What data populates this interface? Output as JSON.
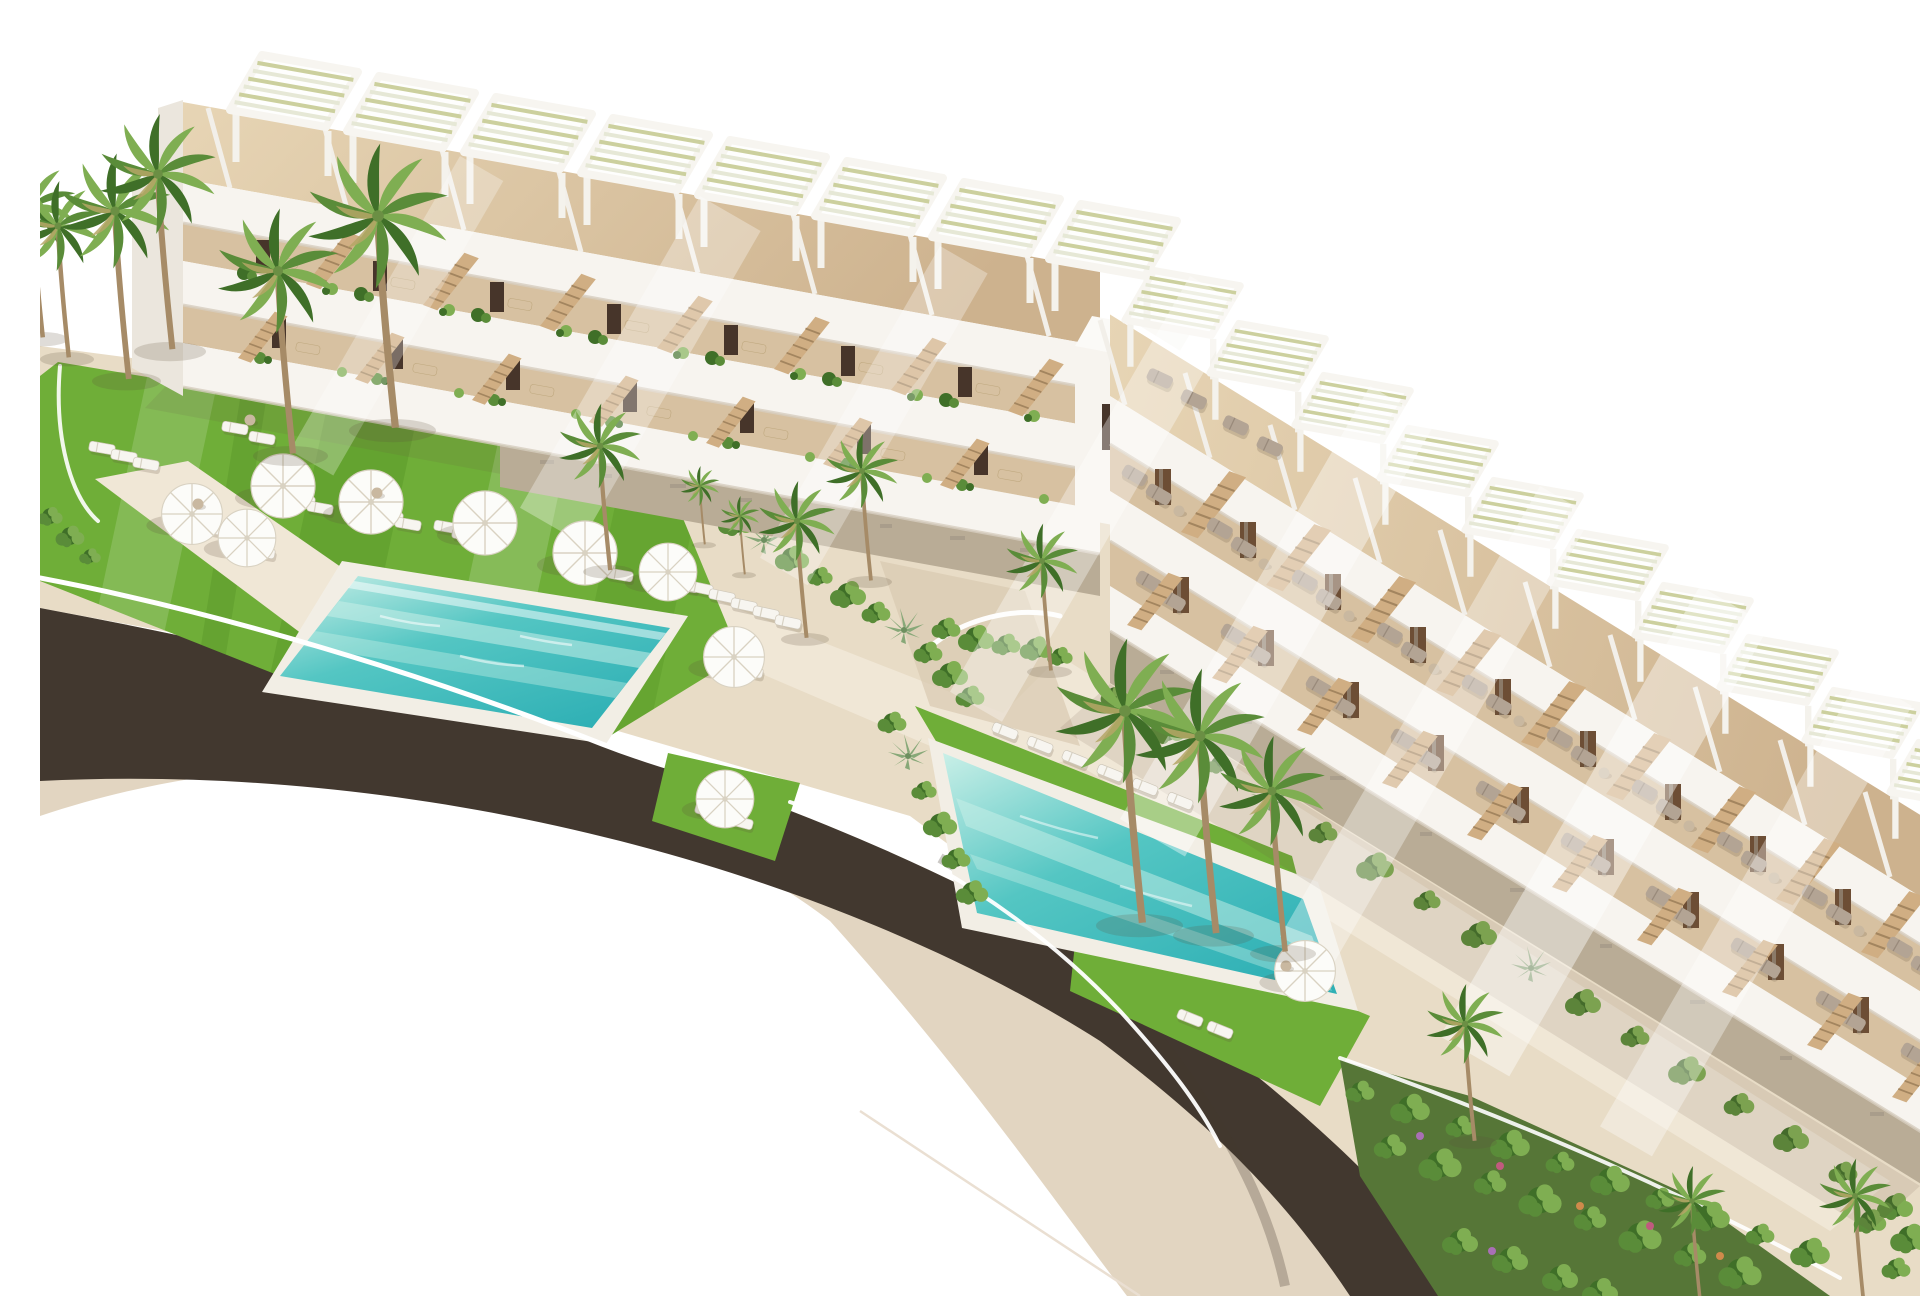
{
  "scene": {
    "title": "Aerial 3D architectural render of a white terraced seaside apartment complex",
    "setting_note": "Two long white terraced apartment blocks with rooftop pergolas and tan roof decks step diagonally across the frame. In front lie bright lawns with white parasols and sun loungers, two turquoise swimming pools with white decks, lush shrub and agave beds, tall fan palms, light stone promenades and a dark curved road with pale sidewalks sweeping around the resort on a pure white background.",
    "features": [
      "left apartment block with rooftop pergolas and balcony terraces",
      "right apartment block stepping down with grey loungers on terraces",
      "white stair tower between the blocks",
      "rectangular turquoise pool beside main lawn",
      "second diagonal turquoise pool near right block",
      "white sun umbrellas",
      "white sun loungers",
      "grey terrace loungers",
      "fan palm trees",
      "shrub and agave planting beds",
      "curved dark asphalt road with beige sidewalks",
      "white boundary walls"
    ],
    "left_block": {
      "pergola_count": 8,
      "visible_levels": 3
    },
    "right_block": {
      "pergola_count": 10,
      "visible_levels": 3
    },
    "pool_count": 2,
    "umbrella_count": 10
  },
  "colors": {
    "white": "#ffffff",
    "buildingFace": "#f7f4ef",
    "buildingShade": "#ebe6dd",
    "bandShadow": "#d7cec0",
    "roofA": "#e7d5b5",
    "roofB": "#cdb28e",
    "terrace": "#d7c1a1",
    "stone": "#b9ac96",
    "stoneDark": "#9b9081",
    "door": "#47352a",
    "wood": "#6d4e35",
    "glass": "#8b7a68",
    "stair": "#d0ae83",
    "stairStep": "#a3855f",
    "lawn": "#6fae38",
    "lawnLight": "#8fc455",
    "lawnDark": "#4c8a1f",
    "poolA": "#c9efe7",
    "poolB": "#54c6c3",
    "poolC": "#2fb0b5",
    "deck": "#f2eee5",
    "base": "#e8dcc6",
    "pathLight": "#f0e7d6",
    "pathShade": "#d9c9b0",
    "road": "#42382f",
    "sidewalk": "#e2d5c1",
    "bedBase": "#567637",
    "trunk": "#a68b67",
    "frond": "#5a8c39",
    "frondLight": "#7fae52",
    "frondDark": "#3f6f28",
    "frondDry": "#b5a666",
    "umbrella": "#fcfcf9",
    "umbrellaEdge": "#d9d2c2",
    "loungerW": "#f7f5f0",
    "loungerG": "#b3a494",
    "table": "#c9b8a0",
    "pergSlatA": "#e6e8d6",
    "pergSlatB": "#ccd09e",
    "shadow": "rgba(95,78,60,0.20)",
    "shadowSoft": "rgba(105,88,66,0.13)",
    "flower1": "#a96fb5",
    "flower2": "#c05a7e",
    "flower3": "#cf8a4b"
  }
}
